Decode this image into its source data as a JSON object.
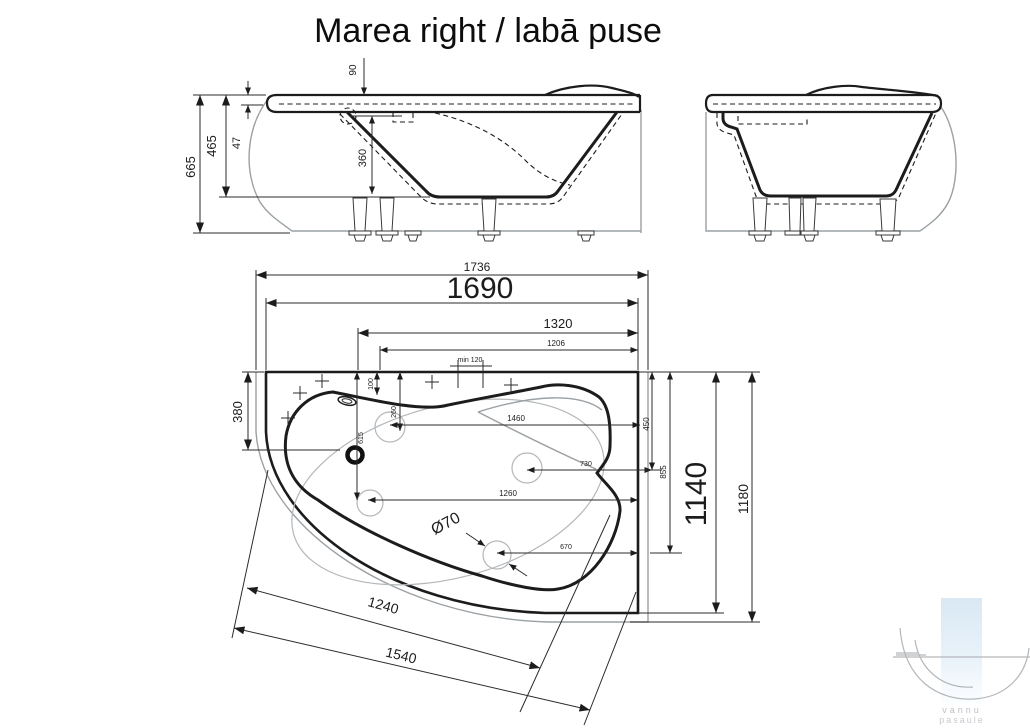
{
  "title": "Marea right / labā puse",
  "side_view": {
    "height_overall": "665",
    "height_inner": "465",
    "rim_offset": "47",
    "overflow_from_rim": "90",
    "overflow_to_floor": "360"
  },
  "plan_view": {
    "length_total": "1736",
    "length_rim": "1690",
    "length_1320": "1320",
    "length_1206": "1206",
    "min_gap": "min 120",
    "offset_380": "380",
    "offset_100": "100",
    "offset_260": "260",
    "offset_615": "615",
    "length_1460": "1460",
    "length_730": "730",
    "length_1260": "1260",
    "length_670": "670",
    "height_450": "450",
    "height_855": "855",
    "width_rim": "1140",
    "width_total": "1180",
    "drain_diameter": "Ø70"
  },
  "panel": {
    "length_inner": "1240",
    "length_outer": "1540"
  },
  "watermark": {
    "line1": "vannu",
    "line2": "pasaule"
  }
}
